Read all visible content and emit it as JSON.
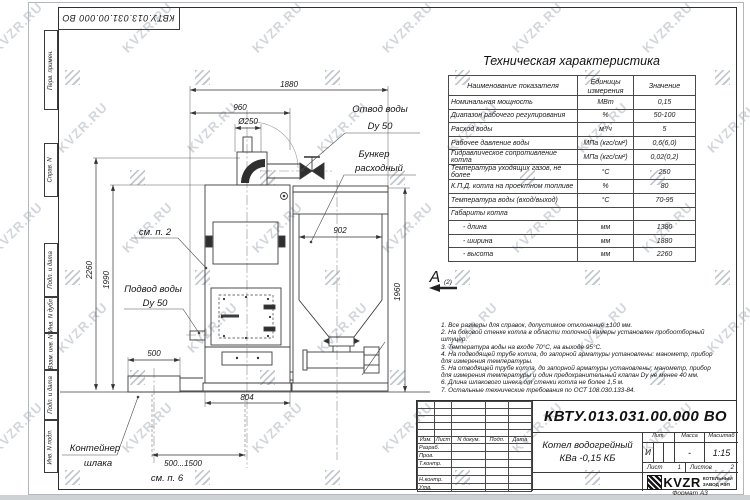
{
  "watermark": {
    "text": "KVZR.RU"
  },
  "margin_columns": [
    "Перв. примен.",
    "Справ. N",
    "Подп. и дата",
    "Инв. N дубл.",
    "Взам. инв. N",
    "Подп. и дата",
    "Инв. N подл."
  ],
  "spec_table": {
    "title": "Техническая характеристика",
    "columns": [
      "Наименование показателя",
      "Единицы измерения",
      "Значение"
    ],
    "rows": [
      [
        "Номинальная мощность",
        "МВт",
        "0,15"
      ],
      [
        "Диапазон рабочего регулирования",
        "%",
        "50-100"
      ],
      [
        "Расход воды",
        "м³/ч",
        "5"
      ],
      [
        "Рабочее давление воды",
        "МПа (кгс/см²)",
        "0,6(6,0)"
      ],
      [
        "Гидравлическое сопротивление котла",
        "МПа (кгс/см²)",
        "0,02(0,2)"
      ],
      [
        "Температура уходящих газов, не более",
        "°С",
        "250"
      ],
      [
        "К.П.Д. котла на проектном топливе",
        "%",
        "80"
      ],
      [
        "Температура воды (вход/выход)",
        "°С",
        "70-95"
      ],
      [
        "Габариты котла",
        "",
        ""
      ],
      [
        "- длина",
        "мм",
        "1380"
      ],
      [
        "- ширина",
        "мм",
        "1880"
      ],
      [
        "- высота",
        "мм",
        "2260"
      ]
    ]
  },
  "notes": [
    "1. Все размеры для справок, допустимое отклонение  ±100 мм.",
    "2. На боковой стенке котла в области топочной камеры установлен пробоотборный штуцер.",
    "3. Температура воды на входе  70°С, на выходе  95°С.",
    "4. На подводящей трубе котла, до запорной арматуры установлены: манометр, прибор для измерения температуры.",
    "5. На отводящей трубе котла, до запорной арматуры установлены: манометр, прибор для измерения температуры и один предохранительный клапан Dу не менее  40 мм.",
    "6. Длина шлакового шнека от стенки котла не более  1,5 м.",
    "7. Остальные технические требования по ОСТ  108.030.133-84."
  ],
  "drawing": {
    "dims": {
      "overall": "1880",
      "front": "960",
      "flue": "Ø250",
      "bunker": "902",
      "bunker_h": "1960",
      "boiler_h": "2260",
      "boiler_h2": "1990",
      "base": "804",
      "container": "500",
      "travel": "500...1500"
    },
    "labels": {
      "outlet1": "Отвод воды",
      "outlet2": "Dy 50",
      "hopper1": "Бункер",
      "hopper2": "расходный",
      "inlet1": "Подвод воды",
      "inlet2": "Dy 50",
      "container1": "Контейнер",
      "container2": "шлака",
      "see2": "см. п. 2",
      "see6": "см. п. 6",
      "view": "А",
      "view_sub": "(2)"
    }
  },
  "title_block": {
    "doc_number": "КВТУ.013.031.00.000  ВО",
    "header": [
      "Изм.",
      "Лист",
      "N докум.",
      "Подп.",
      "Дата"
    ],
    "rows": [
      "Разраб.",
      "Пров.",
      "Т.контр.",
      "",
      "Н.контр.",
      "Утв."
    ],
    "product_line1": "Котел водогрейный",
    "product_line2": "КВа -0,15  КБ",
    "lit_header": "Лит.",
    "mass_header": "Масса",
    "scale_header": "Масштаб",
    "lit": "И",
    "mass": "-",
    "scale": "1:15",
    "sheet_label": "Лист",
    "sheet": "1",
    "sheets_label": "Листов",
    "sheets": "2",
    "brand": "KVZR",
    "brand_sub1": "КОТЕЛЬНЫЙ",
    "brand_sub2": "ЗАВОД РЭП",
    "format": "Формат А3"
  }
}
